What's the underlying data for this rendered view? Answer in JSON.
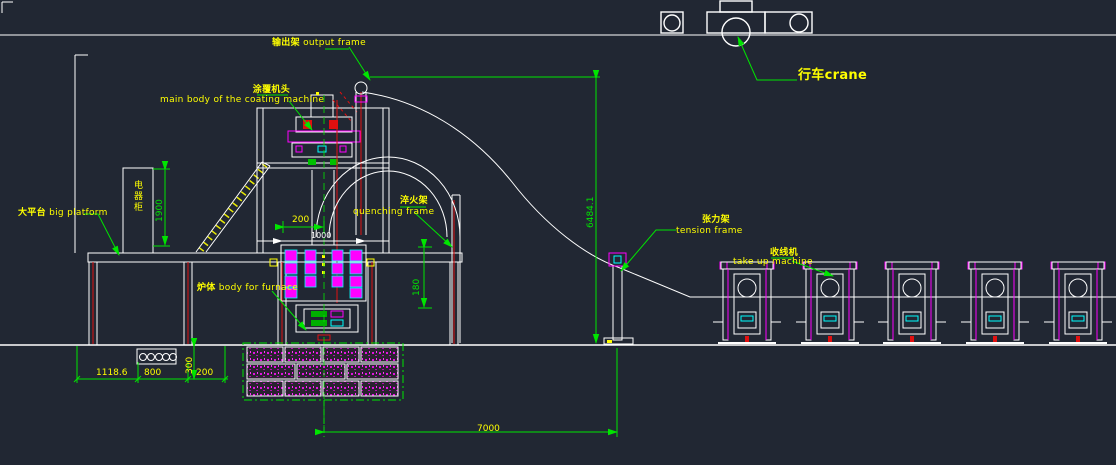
{
  "canvas": {
    "background": "#212733",
    "line_color": "#ffffff",
    "dim_color": "#00e500",
    "label_color": "#ffff00",
    "detail_magenta": "#ff00ff",
    "detail_cyan": "#00ffff",
    "detail_red": "#e01010"
  },
  "labels": {
    "crane": "行车crane",
    "output_frame_zh": "输出架",
    "output_frame_en": "output frame",
    "main_body_zh": "涂覆机头",
    "main_body_en": "main body of the coating machine",
    "big_platform_zh": "大平台",
    "big_platform_en": "big platform",
    "electrical_cabinet": "电器柜",
    "furnace_zh": "炉体",
    "furnace_en": "body for furnace",
    "quenching_zh": "淬火架",
    "quenching_en": "quenching frame",
    "tension_zh": "张力架",
    "tension_en": "tension frame",
    "takeup_zh": "收线机",
    "takeup_en": "take up machine"
  },
  "dimensions": {
    "cabinet_height": "1900",
    "head_offset": "200",
    "furnace_width": "1000",
    "platform_clearance": "180",
    "tower_height": "6484.1",
    "pit_depth": "300",
    "base_left": "1118.6",
    "base_mid": "800",
    "base_right": "200",
    "takeup_span": "7000"
  }
}
